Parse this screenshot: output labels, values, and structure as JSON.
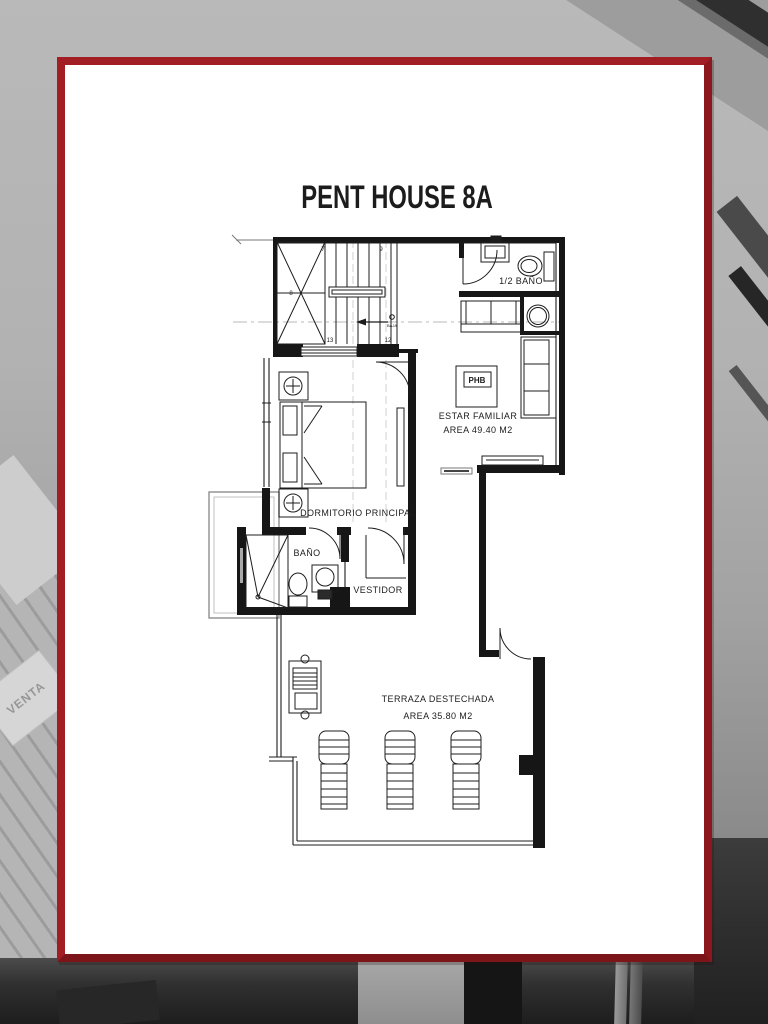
{
  "title": "PENT HOUSE 8A",
  "rooms": {
    "half_bath": {
      "label": "1/2 BAÑO"
    },
    "family_room": {
      "label": "ESTAR FAMILIAR",
      "area": "AREA 49.40 M2",
      "panel_tag": "PHB"
    },
    "master_bedroom": {
      "label": "DORMITORIO PRINCIPAL"
    },
    "bathroom": {
      "label": "BAÑO"
    },
    "walk_in_closet": {
      "label": "VESTIDOR"
    },
    "terrace": {
      "label": "TERRAZA DESTECHADA",
      "area": "AREA 35.80 M2"
    }
  },
  "stairs": {
    "step_top_left": "7",
    "step_top_right": "9",
    "step_mid_left": "8",
    "step_bottom_left": "13",
    "step_bottom_right": "12",
    "direction_label": "BAJA"
  },
  "background": {
    "sign_text": "VENTA"
  },
  "colors": {
    "border_red": "#9c1b20",
    "ink": "#1c1c1c",
    "photo_gray": "#a2a2a2"
  }
}
